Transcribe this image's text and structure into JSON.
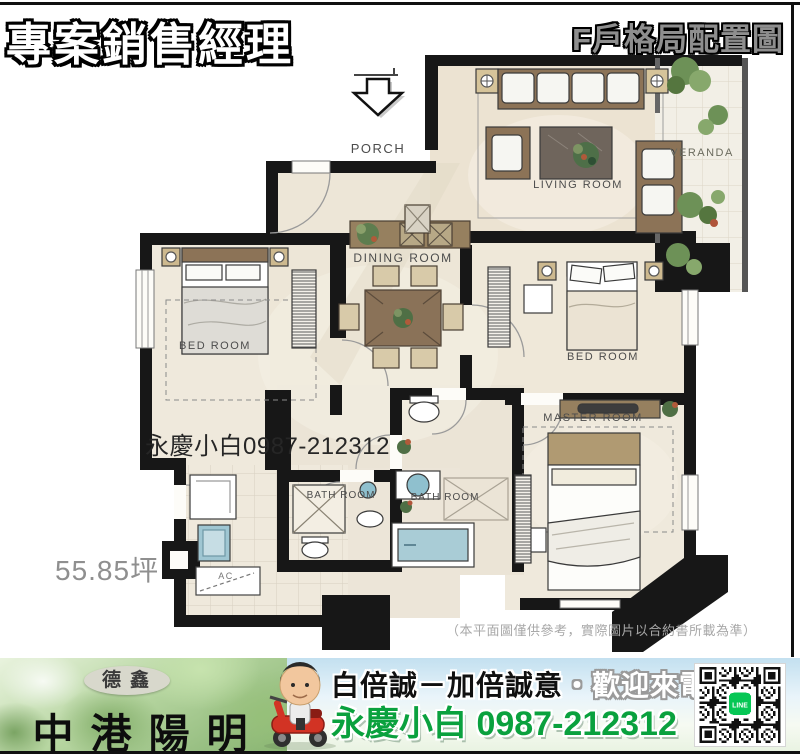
{
  "header": {
    "sales_title": "專案銷售經理",
    "unit_title": "F戶格局配置圖"
  },
  "floorplan": {
    "rooms": {
      "porch": "PORCH",
      "living": "LIVING ROOM",
      "veranda": "VERANDA",
      "dining": "DINING ROOM",
      "bedroom_left": "BED ROOM",
      "bedroom_right": "BED ROOM",
      "master": "MASTER ROOM",
      "bath_left": "BATH ROOM",
      "bath_right": "BATH ROOM",
      "ac": "AC"
    },
    "area": "55.85坪",
    "watermark": "永慶小白0987-212312",
    "disclaimer": "（本平面圖僅供參考，實際圖片以合約書所載為準）"
  },
  "banner": {
    "builder": "德鑫",
    "project": "中港陽明",
    "slogan_strong": "白倍誠－加倍誠意",
    "slogan_light": "・歡迎來電",
    "agent": "永慶小白 0987-212312",
    "qr_label": "LINE",
    "colors": {
      "agent_green": "#0aa13e",
      "line_green": "#06c755"
    }
  }
}
